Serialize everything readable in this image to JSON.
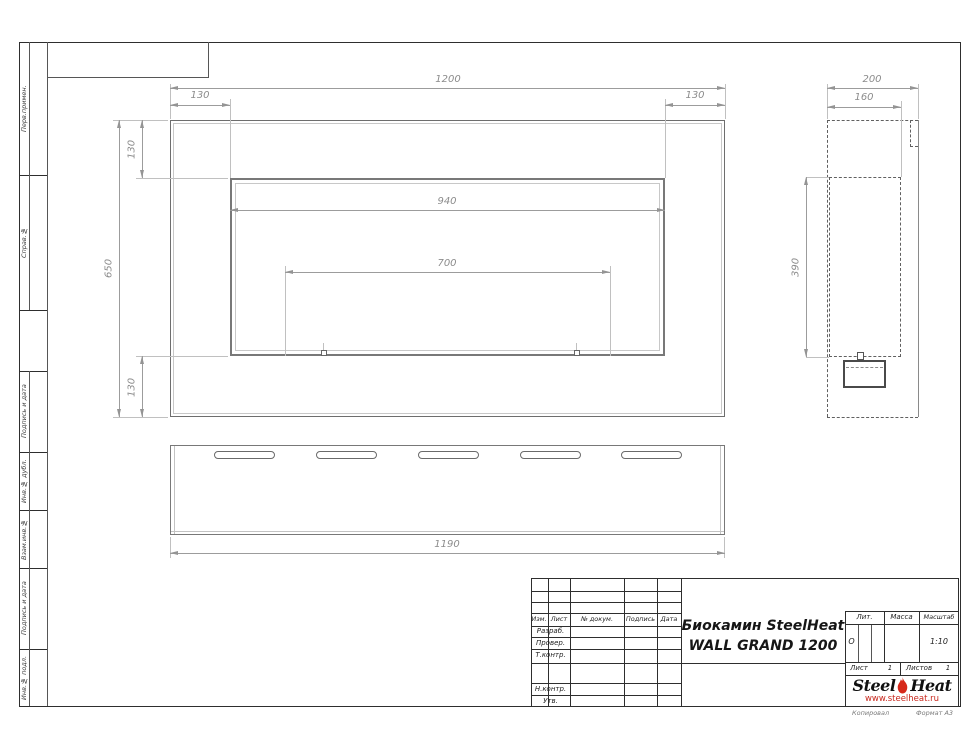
{
  "frame": {
    "left_stamps": [
      {
        "label": "Перв.примен."
      },
      {
        "label": "Справ.№"
      },
      {
        "label": "Подпись и дата"
      },
      {
        "label": "Инв.№ дубл."
      },
      {
        "label": "Взам.инв.№"
      },
      {
        "label": "Подпись и дата"
      },
      {
        "label": "Инв.№ подл."
      }
    ],
    "footer": {
      "copied": "Копировал",
      "format": "Формат А3"
    }
  },
  "drawing": {
    "front_view": {
      "dims": {
        "overall_width": "1200",
        "flange_left": "130",
        "flange_right": "130",
        "overall_height": "650",
        "flange_top": "130",
        "flange_bottom": "130",
        "opening_width": "940",
        "burner_width": "700"
      }
    },
    "side_view": {
      "dims": {
        "depth": "200",
        "inner_depth": "160",
        "opening_height": "390"
      }
    },
    "bottom_view": {
      "dims": {
        "mount_width": "1190"
      }
    }
  },
  "title_block": {
    "rev_header": {
      "izm": "Изм.",
      "list": "Лист",
      "doc": "№ докум.",
      "sign": "Подпись",
      "date": "Дата"
    },
    "roles": {
      "developed": "Разраб.",
      "checked": "Провер.",
      "tcontrol": "Т.контр.",
      "ncontrol": "Н.контр.",
      "approved": "Утв."
    },
    "title_line1": "Биокамин SteelHeat",
    "title_line2": "WALL GRAND 1200",
    "lit": {
      "label": "Лит.",
      "value": "О"
    },
    "mass": {
      "label": "Масса"
    },
    "scale": {
      "label": "Масштаб",
      "value": "1:10"
    },
    "sheet": {
      "label": "Лист",
      "value": "1"
    },
    "sheets": {
      "label": "Листов",
      "value": "1"
    },
    "logo": {
      "steel": "Steel",
      "heat": "Heat",
      "url": "www.steelheat.ru"
    },
    "colors": {
      "flame": "#d6281a",
      "url_red": "#c8271c"
    }
  }
}
